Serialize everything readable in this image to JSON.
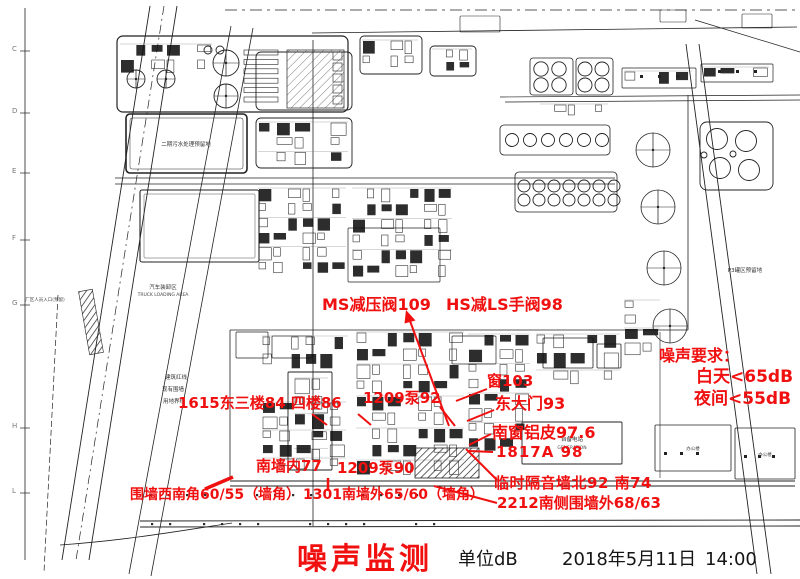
{
  "colors": {
    "annotation_red": "#f01010",
    "map_line": "#222222"
  },
  "annotations": {
    "valve_ms": "MS减压阀109",
    "valve_hs": "HS减LS手阀98",
    "east_building": "1615东三楼84 四楼86",
    "pump_92": "1209泵92",
    "window_103": "窗103",
    "east_gate": "东大门93",
    "south_window": "南窗铝皮97.6",
    "room_1817a": "1817A 98",
    "south_wall_inner": "南墙内77",
    "pump_90": "1209泵90",
    "fence_sw_corner": "围墙西南角60/55（墙角）",
    "south_wall_outer": "1301南墙外65/60（墙角）",
    "temp_sound_barrier": "临时隔音墙北92 南74",
    "fence_2212": "2212南侧围墙外68/63"
  },
  "noise_requirements": {
    "title": "噪声要求：",
    "day": "白天<65dB",
    "night": "夜间<55dB"
  },
  "footer": {
    "title": "噪声监测",
    "unit": "单位dB",
    "date": "2018年5月11日",
    "time": "14:00"
  },
  "map_texts": {
    "truck_area_cn": "汽车装卸区",
    "truck_area_en": "TRUCK LOADING AREA",
    "gate_note": "厂区人员入口(预留)",
    "red_line": "建筑红线",
    "existing_wall": "现有围墙",
    "land_boundary": "用地界线",
    "pond": "二期污水处理预留地",
    "p3_area": "P3罐区预留地",
    "power_cn": "自备电站",
    "power_en": "GENERATION",
    "office": "办公楼",
    "grid_letters": [
      "C",
      "D",
      "E",
      "F",
      "G",
      "H",
      "L"
    ]
  }
}
